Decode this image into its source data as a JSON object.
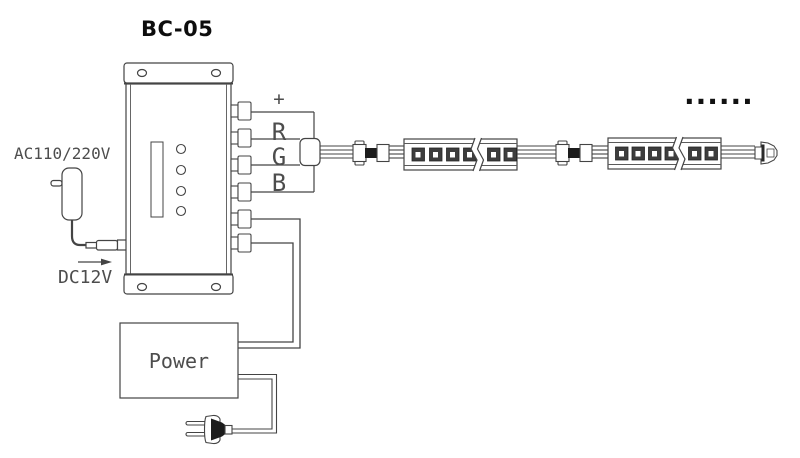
{
  "diagram": {
    "title": "BC-05",
    "adapter": {
      "input_label": "AC110/220V",
      "output_label": "DC12V"
    },
    "controller": {
      "terminal_labels": [
        "+",
        "R",
        "G",
        "B"
      ],
      "terminal_count": 6,
      "button_count": 4
    },
    "power_supply": {
      "label": "Power"
    },
    "led_strip": {
      "segment_count": 2,
      "leds_before_break": 4,
      "leds_after_break": 2,
      "continuation_dots": "......"
    },
    "colors": {
      "line": "#444444",
      "cad_text": "#4d4d4d",
      "title": "#0d0d0d",
      "led_chip": "#3d3d3d",
      "connector_core": "#1c1c1c"
    }
  }
}
